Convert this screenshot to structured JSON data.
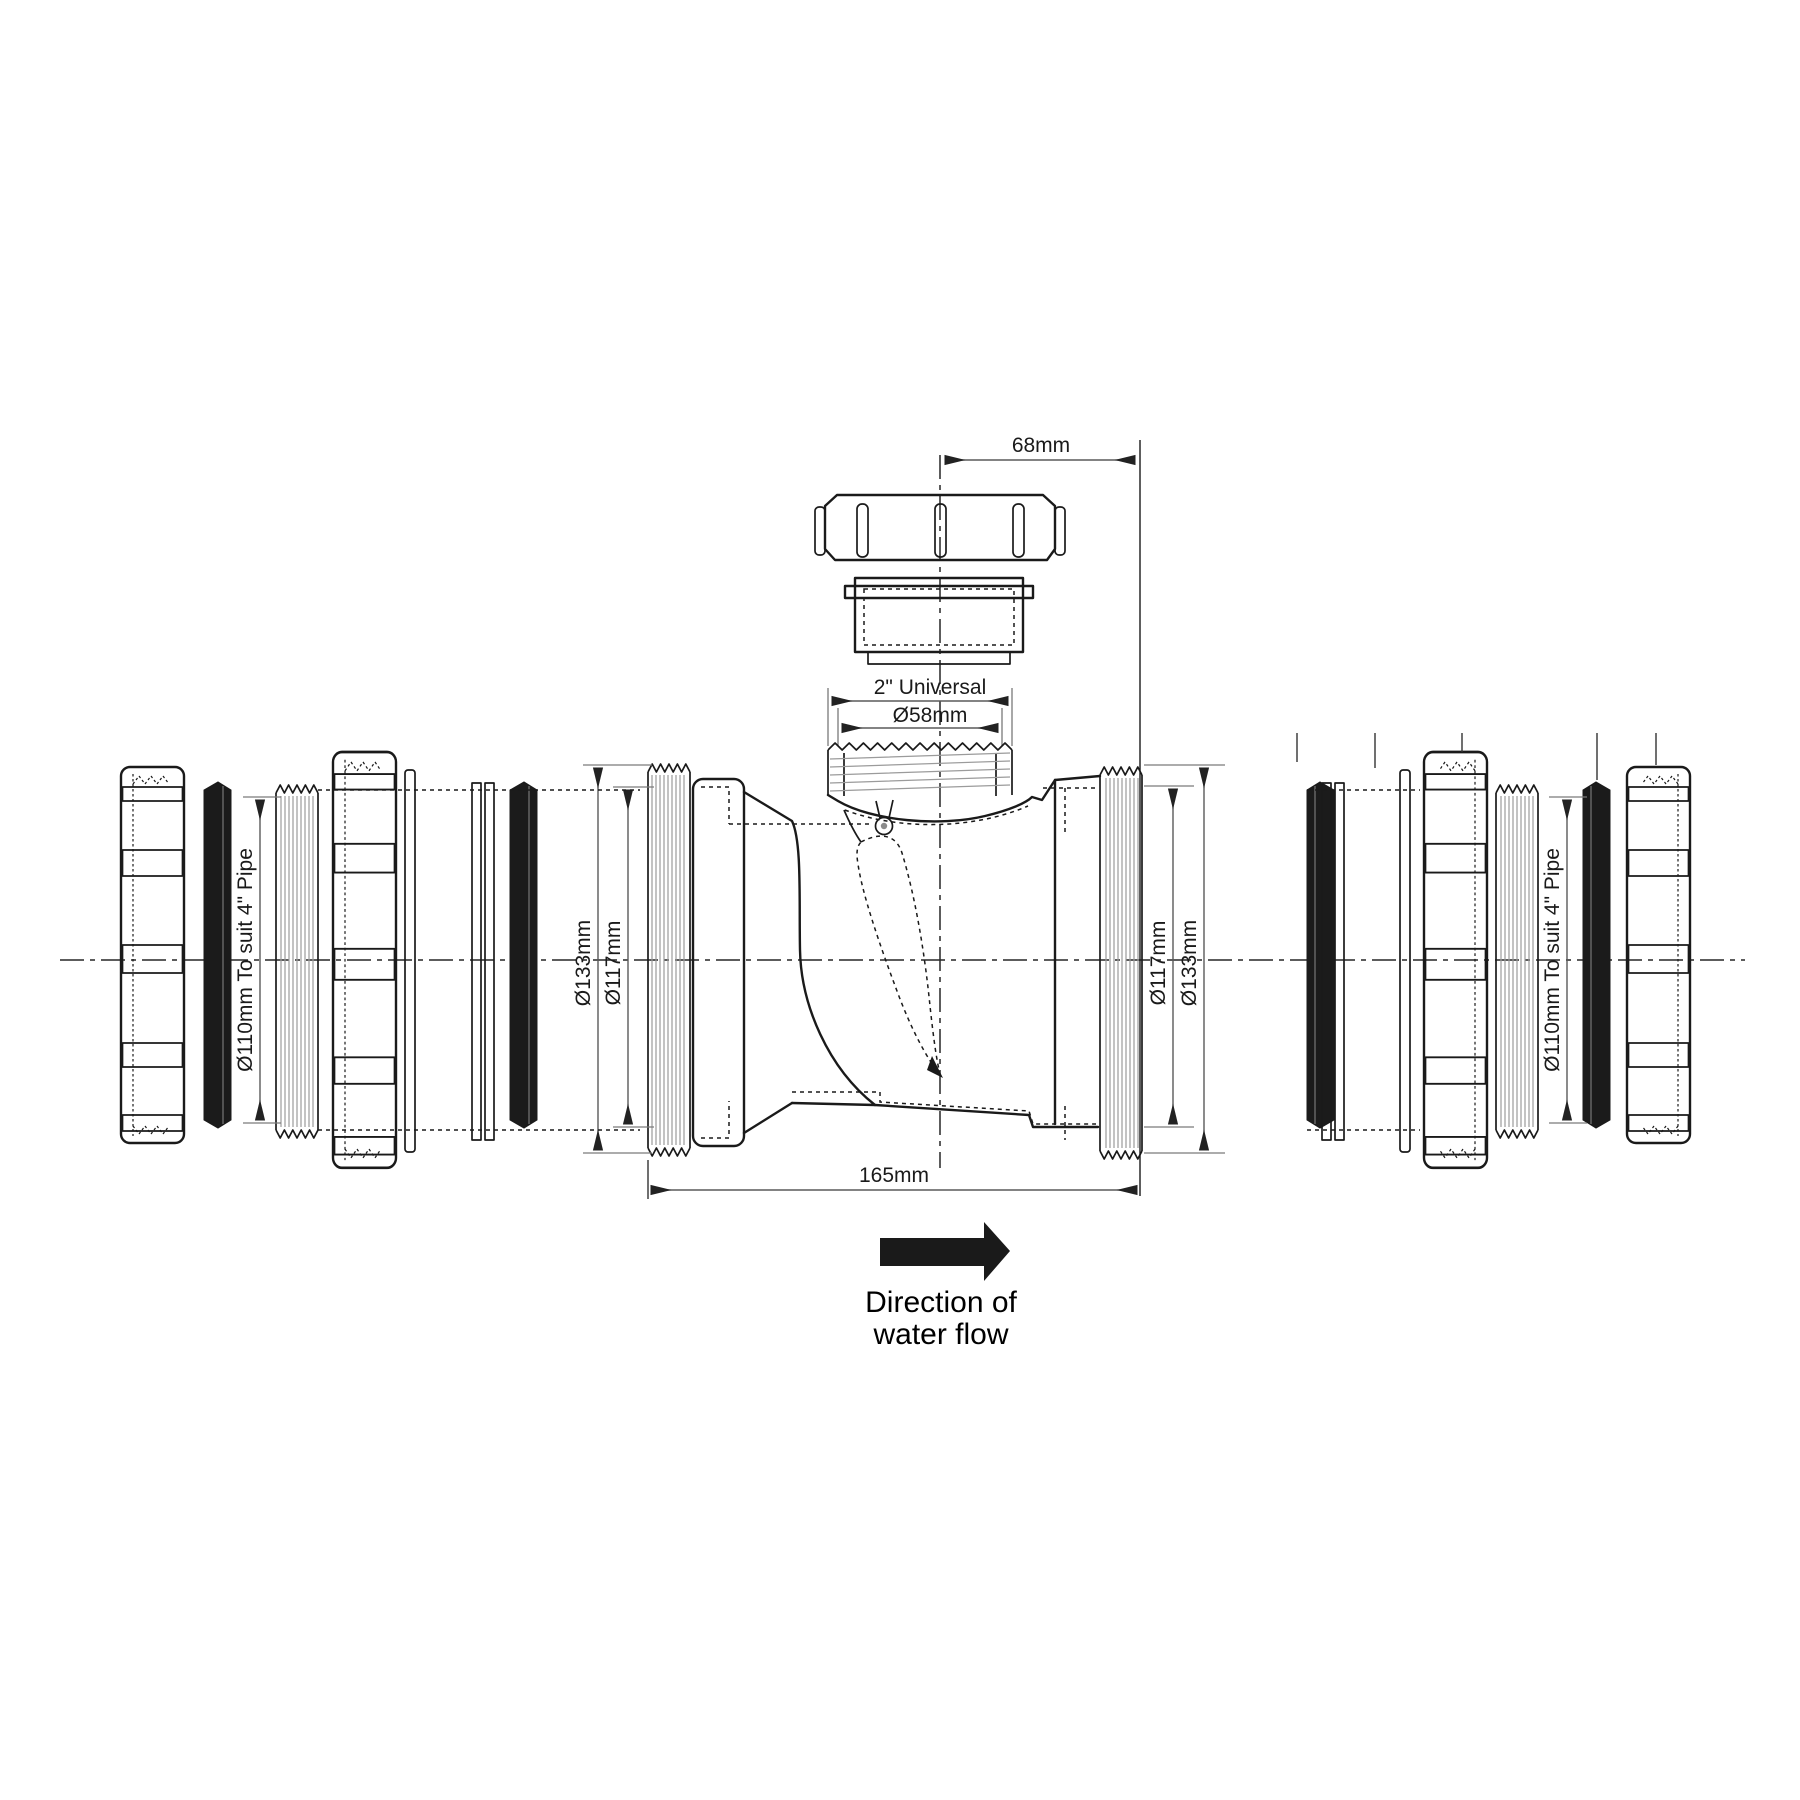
{
  "diagram": {
    "type": "engineering-drawing",
    "subject": "in-line non-return valve with 2\" universal branch and 4\" pipe compression ends, exploded view",
    "dimensions": {
      "branch_offset": "68mm",
      "branch_thread": "2\" Universal",
      "branch_od": "Ø58mm",
      "left_od": "Ø133mm",
      "left_id": "Ø117mm",
      "right_id": "Ø117mm",
      "right_od": "Ø133mm",
      "overall_length": "165mm",
      "left_pipe": "Ø110mm To suit 4\" Pipe",
      "right_pipe": "Ø110mm To suit 4\" Pipe"
    },
    "flow_label": {
      "line1": "Direction of",
      "line2": "water flow"
    },
    "colors": {
      "outline": "#1a1a1a",
      "dimension_line": "#5a5a5a",
      "thread_hatch": "#9b9b9b",
      "seal_fill": "#1b1b1b",
      "background": "#ffffff"
    }
  }
}
